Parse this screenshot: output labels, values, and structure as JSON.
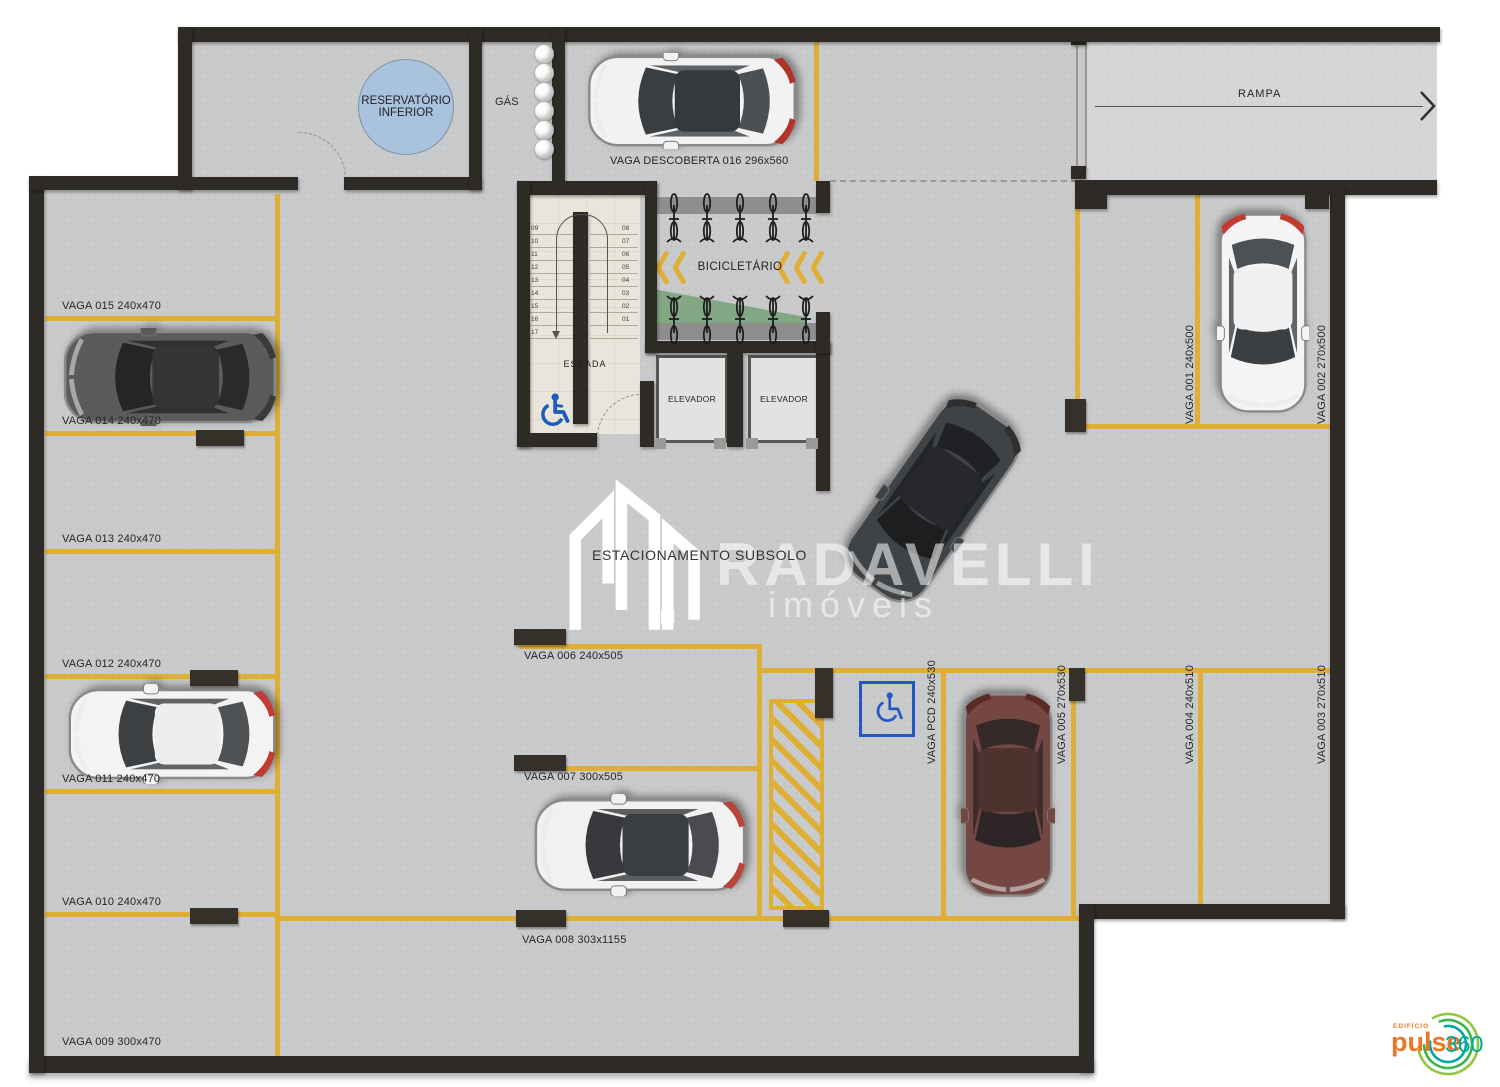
{
  "title": "ESTACIONAMENTO SUBSOLO",
  "watermark": {
    "brand": "RADAVELLI",
    "sub": "imóveis"
  },
  "top": {
    "reservatorio_line1": "RESERVATÓRIO",
    "reservatorio_line2": "INFERIOR",
    "gas": "GÁS",
    "rampa": "RAMPA",
    "vaga016": "VAGA DESCOBERTA 016 296x560"
  },
  "stairwell": {
    "label": "ESCADA",
    "left_numbers": [
      "09",
      "10",
      "11",
      "12",
      "13",
      "14",
      "15",
      "16",
      "17"
    ],
    "right_numbers": [
      "08",
      "07",
      "06",
      "05",
      "04",
      "03",
      "02",
      "01"
    ]
  },
  "bicicletario": {
    "label": "BICICLETÁRIO"
  },
  "elevators": {
    "left": "ELEVADOR",
    "right": "ELEVADOR"
  },
  "left_spots": [
    "VAGA 015 240x470",
    "VAGA 014 240x470",
    "VAGA 013 240x470",
    "VAGA 012 240x470",
    "VAGA 011 240x470",
    "VAGA 010 240x470",
    "VAGA 009 300x470"
  ],
  "mid_spots": [
    "VAGA 006 240x505",
    "VAGA 007 300x505",
    "VAGA 008 303x1155"
  ],
  "right_top_spots": [
    "VAGA 001 240x500",
    "VAGA 002 270x500"
  ],
  "right_spots": [
    "VAGA PCD 240x530",
    "VAGA 005 270x530",
    "VAGA 004 240x510",
    "VAGA 003 270x510"
  ],
  "logo": {
    "edificio": "EDIFÍCIO",
    "pulse": "pulse",
    "suffix": "360"
  },
  "colors": {
    "floor": "#c9cacb",
    "ramp_floor": "#d5d6d7",
    "wall": "#2e2a25",
    "line_yellow": "#dfae35",
    "accessible_blue": "#1d5bbf",
    "reservoir_blue": "#a9c3de",
    "green_area": "#7fa47f",
    "stair_floor": "#eae5da",
    "logo_orange": "#ee7623",
    "logo_teal": "#00a79d"
  }
}
